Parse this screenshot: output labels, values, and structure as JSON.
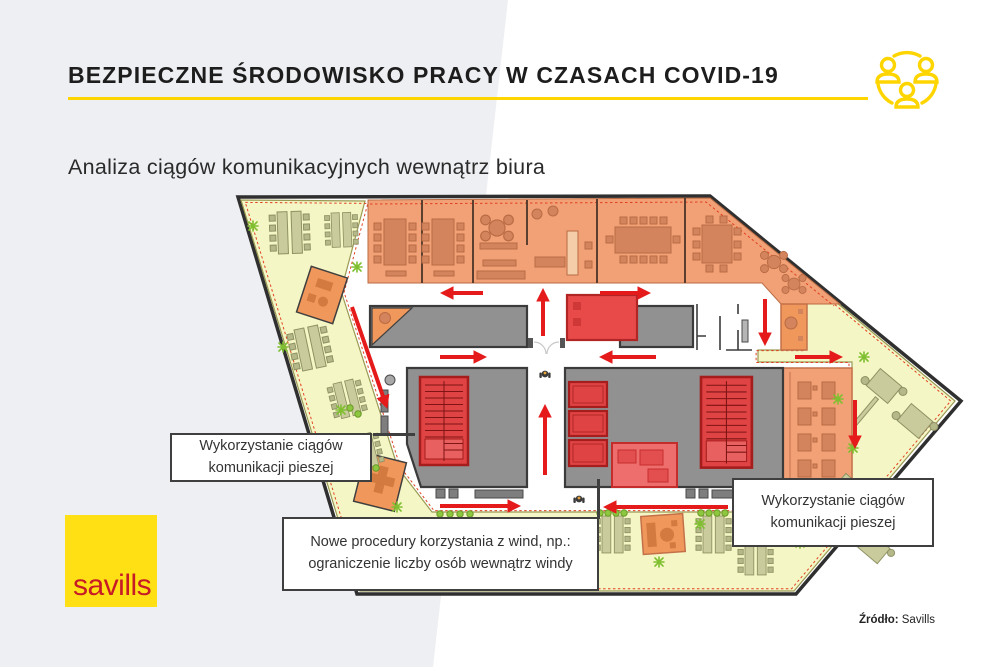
{
  "header": {
    "title": "BEZPIECZNE ŚRODOWISKO PRACY W CZASACH COVID-19",
    "subtitle": "Analiza ciągów komunikacyjnych wewnątrz biura",
    "icon": "people-network-icon",
    "accent_color": "#FFD500"
  },
  "floor_plan": {
    "annotations": [
      {
        "line1": "Wykorzystanie ciągów",
        "line2": "komunikacji pieszej"
      },
      {
        "line1": "Nowe procedury korzystania z wind, np.:",
        "line2": "ograniczenie liczby osób wewnątrz windy"
      },
      {
        "line1": "Wykorzystanie ciągów",
        "line2": "komunikacji pieszej"
      }
    ],
    "colors": {
      "open_space": "#F5F6C5",
      "meeting_rooms": "#F2A177",
      "core": "#919191",
      "stairs_elevators": "#E04343",
      "circulation_arrows": "#E51A1A",
      "dashed_boundary": "#E04020"
    }
  },
  "footer": {
    "logo_text": "savills",
    "logo_bg": "#FFE014",
    "logo_color": "#C61A27",
    "source_label": "Źródło:",
    "source_value": "Savills"
  }
}
